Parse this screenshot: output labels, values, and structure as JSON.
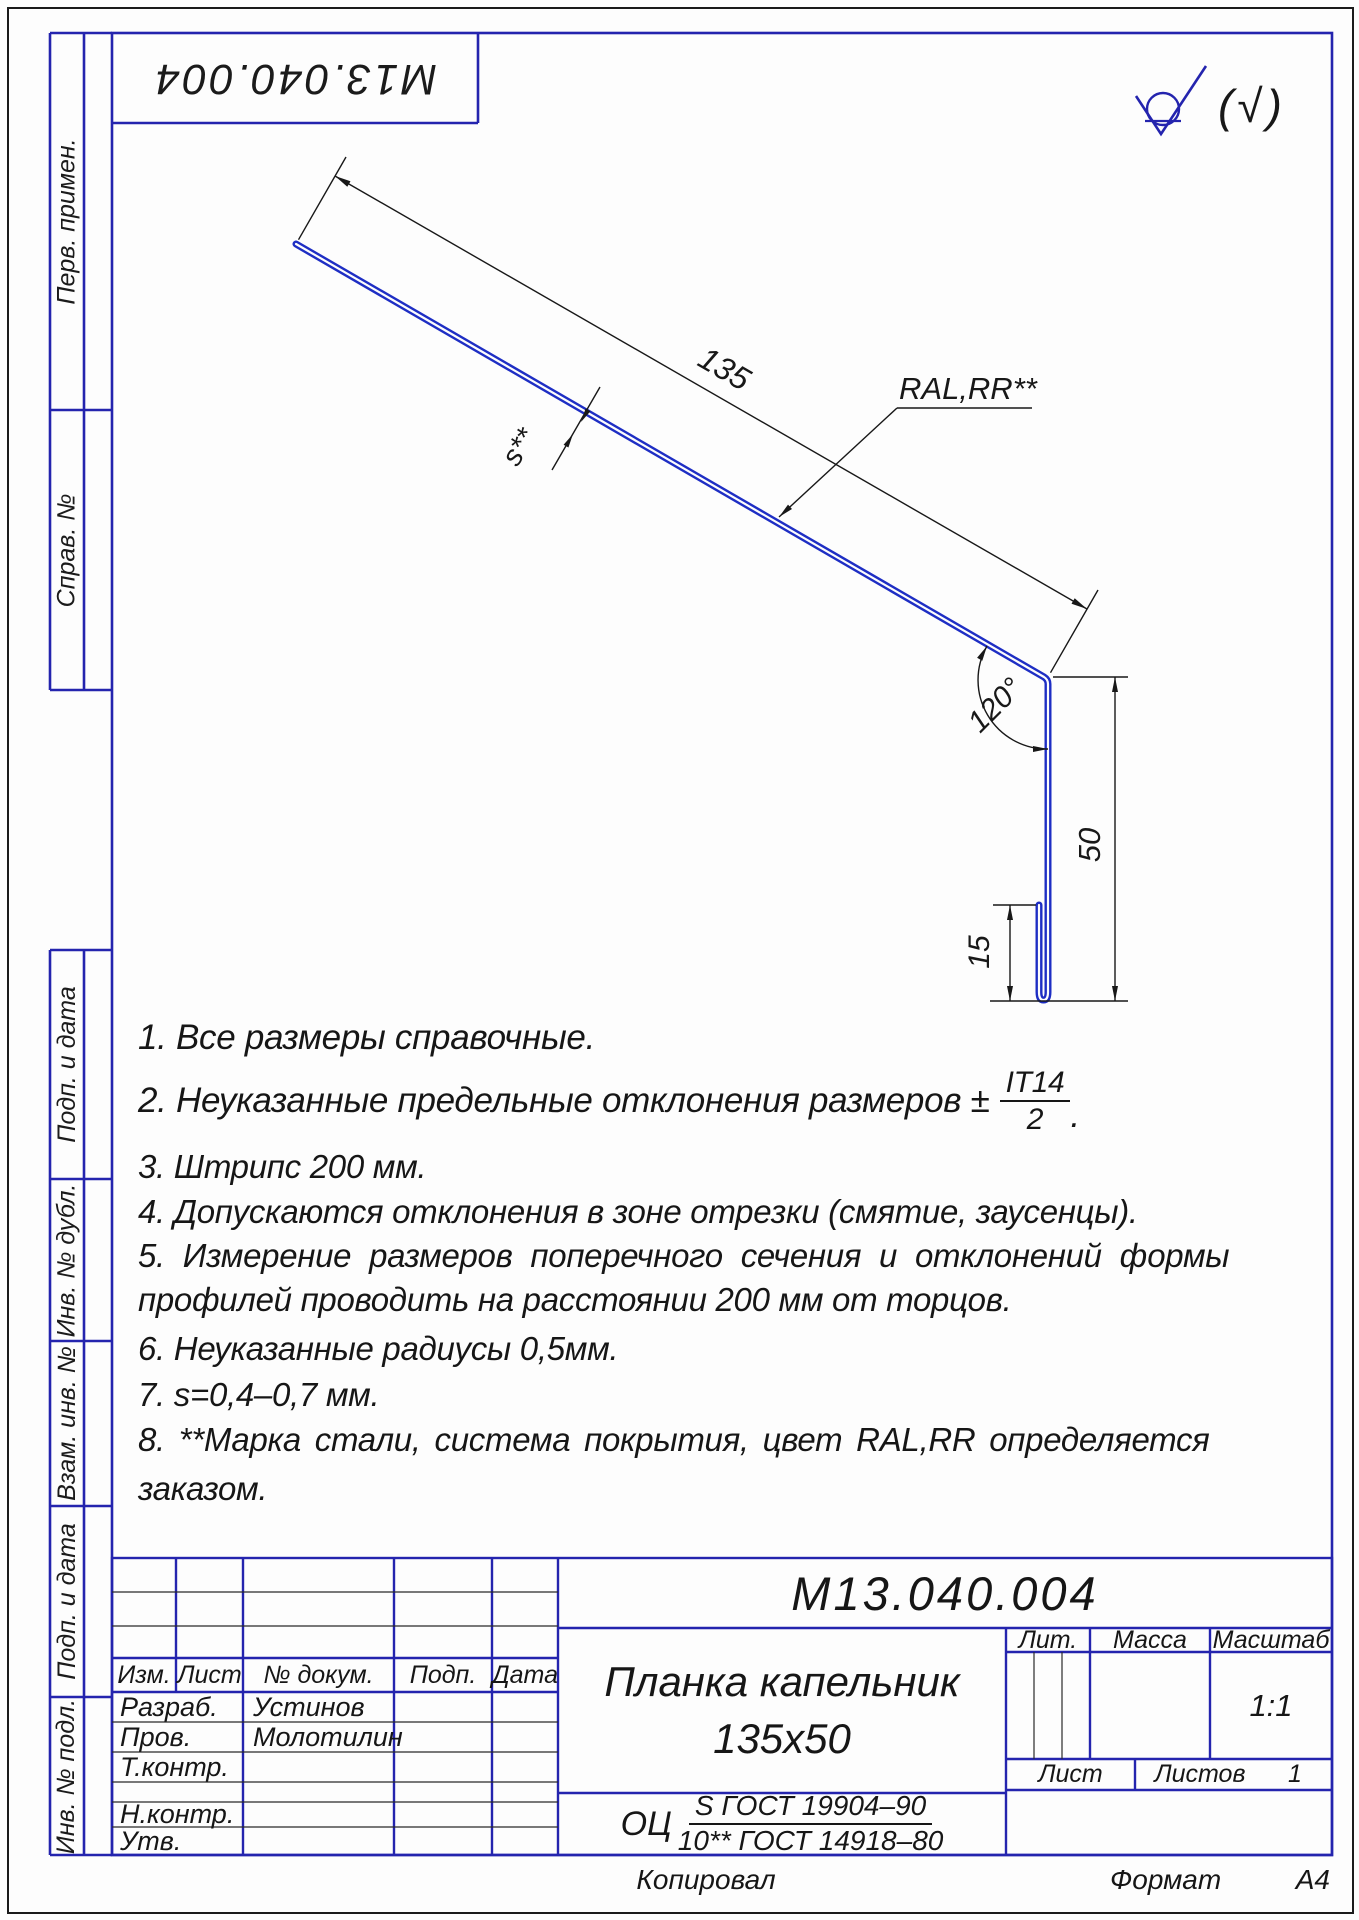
{
  "frame": {
    "top_labels": [
      "Перв. примен.",
      "Справ. №"
    ],
    "bottom_labels": [
      "Подп. и дата",
      "Инв. № дубл.",
      "Взам. инв. №",
      "Подп. и дата",
      "Инв. № подл."
    ],
    "stamp_number": "М13.040.004"
  },
  "surface_finish": {
    "bracket_mark": "(√)"
  },
  "drawing": {
    "dim_length": "135",
    "dim_height": "50",
    "dim_hem": "15",
    "dim_angle": "120°",
    "dim_thickness": "s**",
    "coating_label": "RAL,RR**"
  },
  "notes": {
    "n1": "1.  Все размеры справочные.",
    "n2_prefix": "2.  Неуказанные предельные отклонения размеров ±",
    "n2_frac_num": "IT14",
    "n2_frac_den": "2",
    "n2_suffix": ".",
    "n3": "3.  Штрипс 200 мм.",
    "n4": "4.  Допускаются отклонения в зоне отрезки (смятие, заусенцы).",
    "n5_line1": "5.  Измерение размеров поперечного сечения и отклонений формы",
    "n5_line2": "профилей проводить на расстоянии 200 мм от торцов.",
    "n6": "6.  Неуказанные  радиусы 0,5мм.",
    "n7": "7.  s=0,4–0,7 мм.",
    "n8_line1": "8.  **Марка стали, система покрытия, цвет RAL,RR  определяется",
    "n8_line2": "заказом."
  },
  "title_block": {
    "designation": "М13.040.004",
    "name_line1": "Планка капельник",
    "name_line2": "135х50",
    "material_prefix": "ОЦ",
    "material_num": "S ГОСТ 19904–90",
    "material_den": "10** ГОСТ 14918–80",
    "header": {
      "izm": "Изм.",
      "list": "Лист",
      "doc": "№ докум.",
      "podp": "Подп.",
      "data": "Дата"
    },
    "rows": [
      {
        "label": "Разраб.",
        "name": "Устинов"
      },
      {
        "label": "Пров.",
        "name": "Молотилин"
      },
      {
        "label": "Т.контр.",
        "name": ""
      },
      {
        "label": "",
        "name": ""
      },
      {
        "label": "Н.контр.",
        "name": ""
      },
      {
        "label": "Утв.",
        "name": ""
      }
    ],
    "lit_label": "Лит.",
    "mass_label": "Масса",
    "scale_label": "Масштаб",
    "scale_value": "1:1",
    "sheet_label": "Лист",
    "sheets_label": "Листов",
    "sheets_value": "1"
  },
  "footer": {
    "copied": "Копировал",
    "format_label": "Формат",
    "format_value": "А4"
  }
}
